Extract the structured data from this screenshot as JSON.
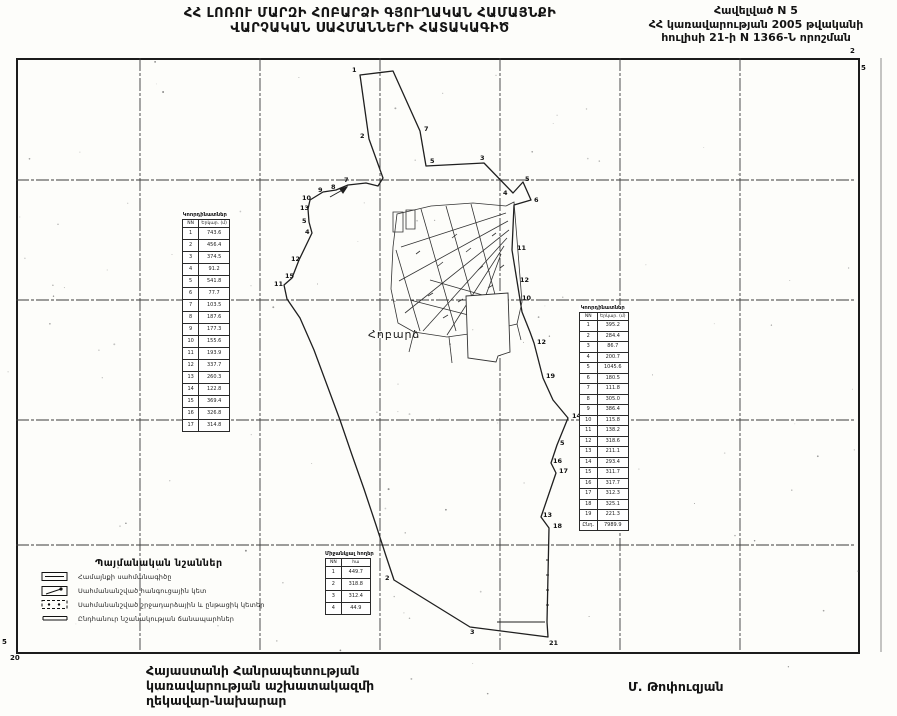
{
  "header": {
    "title_line1": "ՀՀ ԼՈՌՈՒ ՄԱՐԶԻ ՀՈԲԱՐՁԻ ԳՅՈՒՂԱԿԱՆ ՀԱՄԱՅՆՔԻ",
    "title_line2": "ՎԱՐՉԱԿԱՆ ՍԱՀՄԱՆՆԵՐԻ ՀԱՏԱԿԱԳԻԾ"
  },
  "annex": {
    "line1": "Հավելված N 5",
    "line2": "ՀՀ կառավարության 2005 թվականի",
    "line3": "հուլիսի 21-ի N 1366-Ն որոշման"
  },
  "map": {
    "settlement_label": "Հոբարձ",
    "corner_labels": [
      {
        "t": "2",
        "x": 850,
        "y": 48
      },
      {
        "t": "5",
        "x": 861,
        "y": 65
      },
      {
        "t": "5",
        "x": 2,
        "y": 639
      },
      {
        "t": "20",
        "x": 10,
        "y": 655
      }
    ],
    "boundary_point_labels": [
      {
        "t": "1",
        "x": 352,
        "y": 67
      },
      {
        "t": "7",
        "x": 424,
        "y": 126
      },
      {
        "t": "2",
        "x": 360,
        "y": 133
      },
      {
        "t": "5",
        "x": 430,
        "y": 158
      },
      {
        "t": "3",
        "x": 480,
        "y": 155
      },
      {
        "t": "4",
        "x": 503,
        "y": 190
      },
      {
        "t": "5",
        "x": 525,
        "y": 176
      },
      {
        "t": "6",
        "x": 534,
        "y": 197
      },
      {
        "t": "7",
        "x": 344,
        "y": 177
      },
      {
        "t": "8",
        "x": 331,
        "y": 184
      },
      {
        "t": "9",
        "x": 318,
        "y": 187
      },
      {
        "t": "10",
        "x": 302,
        "y": 195
      },
      {
        "t": "13",
        "x": 300,
        "y": 205
      },
      {
        "t": "5",
        "x": 302,
        "y": 218
      },
      {
        "t": "4",
        "x": 305,
        "y": 229
      },
      {
        "t": "12",
        "x": 291,
        "y": 256
      },
      {
        "t": "15",
        "x": 285,
        "y": 273
      },
      {
        "t": "11",
        "x": 274,
        "y": 281
      },
      {
        "t": "11",
        "x": 517,
        "y": 245
      },
      {
        "t": "12",
        "x": 520,
        "y": 277
      },
      {
        "t": "10",
        "x": 522,
        "y": 295
      },
      {
        "t": "12",
        "x": 537,
        "y": 339
      },
      {
        "t": "19",
        "x": 546,
        "y": 373
      },
      {
        "t": "14",
        "x": 572,
        "y": 413
      },
      {
        "t": "5",
        "x": 560,
        "y": 440
      },
      {
        "t": "16",
        "x": 553,
        "y": 458
      },
      {
        "t": "17",
        "x": 559,
        "y": 468
      },
      {
        "t": "13",
        "x": 543,
        "y": 512
      },
      {
        "t": "18",
        "x": 553,
        "y": 523
      },
      {
        "t": "2",
        "x": 385,
        "y": 575
      },
      {
        "t": "3",
        "x": 470,
        "y": 629
      },
      {
        "t": "21",
        "x": 549,
        "y": 640
      }
    ]
  },
  "left_table": {
    "title": "Կոորդինատներ",
    "col1": "NN",
    "col2": "Երկար. (մ)",
    "rows": [
      [
        "1",
        "743.6"
      ],
      [
        "2",
        "456.4"
      ],
      [
        "3",
        "374.5"
      ],
      [
        "4",
        "91.2"
      ],
      [
        "5",
        "541.8"
      ],
      [
        "6",
        "77.7"
      ],
      [
        "7",
        "103.5"
      ],
      [
        "8",
        "187.6"
      ],
      [
        "9",
        "177.3"
      ],
      [
        "10",
        "155.6"
      ],
      [
        "11",
        "193.9"
      ],
      [
        "12",
        "337.7"
      ],
      [
        "13",
        "260.3"
      ],
      [
        "14",
        "122.8"
      ],
      [
        "15",
        "369.4"
      ],
      [
        "16",
        "326.8"
      ],
      [
        "17",
        "314.8"
      ]
    ]
  },
  "right_table": {
    "title": "Կոորդինատներ",
    "col1": "NN",
    "col2": "Երկար. (մ)",
    "rows": [
      [
        "1",
        "395.2"
      ],
      [
        "2",
        "284.4"
      ],
      [
        "3",
        "86.7"
      ],
      [
        "4",
        "200.7"
      ],
      [
        "5",
        "1045.6"
      ],
      [
        "6",
        "180.5"
      ],
      [
        "7",
        "111.8"
      ],
      [
        "8",
        "305.0"
      ],
      [
        "9",
        "386.4"
      ],
      [
        "10",
        "115.8"
      ],
      [
        "11",
        "138.2"
      ],
      [
        "12",
        "318.6"
      ],
      [
        "13",
        "211.1"
      ],
      [
        "14",
        "293.4"
      ],
      [
        "15",
        "311.7"
      ],
      [
        "16",
        "317.7"
      ],
      [
        "17",
        "312.3"
      ],
      [
        "18",
        "325.1"
      ],
      [
        "19",
        "221.3"
      ],
      [
        "Ընդ.",
        "7989.9"
      ]
    ]
  },
  "bottom_table": {
    "title": "Միջանկյալ հողեր",
    "col1": "NN",
    "col2": "հա",
    "rows": [
      [
        "1",
        "449.7"
      ],
      [
        "2",
        "318.8"
      ],
      [
        "3",
        "312.4"
      ],
      [
        "4",
        "44.9"
      ]
    ]
  },
  "legend": {
    "title": "Պայմանական նշաններ",
    "items": [
      {
        "symbol": "boundary-line",
        "label": "Համայնքի սահմանագիծը"
      },
      {
        "symbol": "node-point",
        "label": "Սահմանանշված հանգուցային կետ"
      },
      {
        "symbol": "turning-point",
        "label": "Սահմանանշված շրջադարձային և ընթացիկ կետեր"
      },
      {
        "symbol": "road",
        "label": "Ընդհանուր նշանակության ճանապարհներ"
      }
    ]
  },
  "footer": {
    "line1": "Հայաստանի Հանրապետության",
    "line2": "կառավարության աշխատակազմի",
    "line3": "ղեկավար-նախարար",
    "signature": "Մ. Թոփուզյան"
  }
}
